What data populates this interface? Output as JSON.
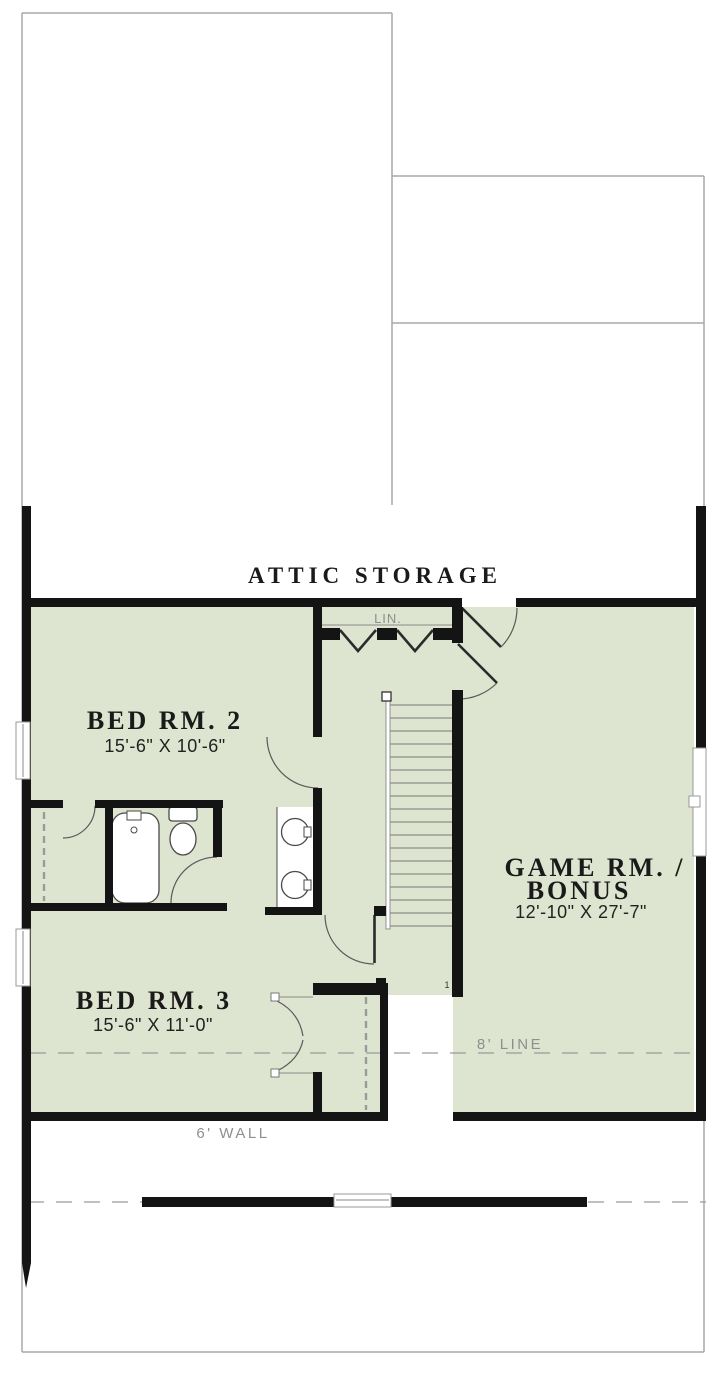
{
  "plan": {
    "attic_label": "ATTIC STORAGE",
    "rooms": [
      {
        "name": "BED RM. 2",
        "dims": "15'-6\" X 10'-6\""
      },
      {
        "name": "BED RM. 3",
        "dims": "15'-6\" X 11'-0\""
      },
      {
        "name_line1": "GAME RM. /",
        "name_line2": "BONUS",
        "dims": "12'-10\" X 27'-7\""
      }
    ],
    "annotations": {
      "linen_closet": "LIN.",
      "ceiling_line": "8' LINE",
      "knee_wall": "6' WALL",
      "stair_note": "1"
    },
    "colors": {
      "floor_fill": "#dde4cf",
      "wall": "#141414",
      "roof_outline": "#a9a9a9",
      "annotation_text": "#8f8f8f",
      "label_text": "#1a1a1a",
      "fixture_stroke": "#4a4a4a",
      "door_stroke": "#5a5a5a"
    }
  },
  "stairs": {
    "tread_count": 18,
    "tread_start_y": 705,
    "tread_spacing": 13,
    "x_start": 390,
    "x_end": 452
  }
}
